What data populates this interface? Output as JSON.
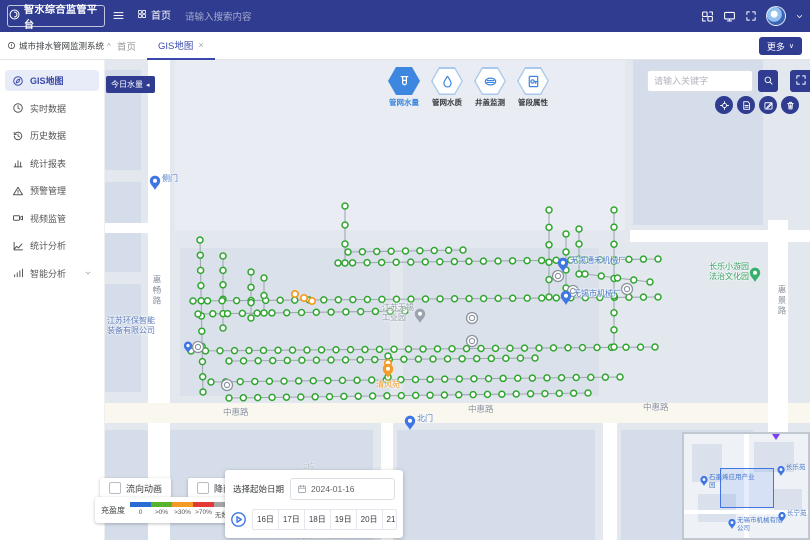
{
  "header": {
    "logo_text": "智水综合监管平台",
    "breadcrumb_home": "首页",
    "search_placeholder": "请输入搜索内容"
  },
  "tab_bar": {
    "tabs": [
      {
        "label": "首页",
        "active": false,
        "closable": false
      },
      {
        "label": "GIS地图",
        "active": true,
        "closable": true
      }
    ],
    "more_label": "更多"
  },
  "sidebar": {
    "title": "城市排水管网监测系统",
    "items": [
      {
        "label": "GIS地图",
        "icon": "compass",
        "active": true
      },
      {
        "label": "实时数据",
        "icon": "clock",
        "active": false
      },
      {
        "label": "历史数据",
        "icon": "history",
        "active": false
      },
      {
        "label": "统计报表",
        "icon": "bar-chart",
        "active": false
      },
      {
        "label": "预警管理",
        "icon": "alert",
        "active": false
      },
      {
        "label": "视频监管",
        "icon": "video",
        "active": false
      },
      {
        "label": "统计分析",
        "icon": "trend",
        "active": false
      },
      {
        "label": "智能分析",
        "icon": "signal",
        "active": false,
        "expandable": true
      }
    ]
  },
  "map": {
    "today_water_button": "今日水量",
    "layer_tools": [
      {
        "label": "管网水量",
        "icon": "water-meter",
        "active": true
      },
      {
        "label": "管网水质",
        "icon": "water-drop",
        "active": false
      },
      {
        "label": "井盖监测",
        "icon": "manhole",
        "active": false
      },
      {
        "label": "管段属性",
        "icon": "pipe",
        "active": false
      }
    ],
    "keyword_placeholder": "请输入关键字",
    "action_buttons": [
      {
        "icon": "locate"
      },
      {
        "icon": "report"
      },
      {
        "icon": "edit"
      },
      {
        "icon": "delete"
      }
    ],
    "road_labels": [
      {
        "text": "惠畅路",
        "x": 46,
        "y": 215,
        "vertical": true,
        "faint": false
      },
      {
        "text": "惠景路",
        "x": 671,
        "y": 225,
        "vertical": true,
        "faint": false
      },
      {
        "text": "中惠路",
        "x": 118,
        "y": 346,
        "vertical": false,
        "faint": false
      },
      {
        "text": "中惠路",
        "x": 363,
        "y": 343,
        "vertical": false,
        "faint": false
      },
      {
        "text": "中惠路",
        "x": 538,
        "y": 341,
        "vertical": false,
        "faint": false
      },
      {
        "text": "2栋",
        "x": 198,
        "y": 401,
        "vertical": false,
        "faint": true
      },
      {
        "text": "无锡环保机械",
        "x": 193,
        "y": 470,
        "vertical": false,
        "faint": true
      }
    ],
    "pois": [
      {
        "kind": "pin",
        "pin_color": "#3f76e4",
        "x": 50,
        "y": 130,
        "lines": [
          "侧门"
        ],
        "side": "right",
        "label_color": "#4a79c9"
      },
      {
        "kind": "pin",
        "pin_color": "#3f76e4",
        "x": 305,
        "y": 370,
        "lines": [
          "北门"
        ],
        "side": "right",
        "label_color": "#4a79c9"
      },
      {
        "kind": "pin",
        "pin_color": "#3f76e4",
        "x": 83,
        "y": 293,
        "lines": [],
        "side": "right",
        "label_color": "#4a79c9"
      },
      {
        "kind": "pin",
        "pin_color": "#3f76e4",
        "x": 458,
        "y": 212,
        "lines": [
          "无锡通禾机械厂"
        ],
        "side": "right",
        "label_color": "#4a79c9"
      },
      {
        "kind": "pin",
        "pin_color": "#3f76e4",
        "x": 461,
        "y": 245,
        "lines": [
          "无锡市机械厂"
        ],
        "side": "right",
        "label_color": "#4a79c9"
      },
      {
        "kind": "pin",
        "pin_color": "#35b06b",
        "x": 650,
        "y": 222,
        "lines": [
          "长乐小游园",
          "法治文化园"
        ],
        "side": "left",
        "label_color": "#35a05f"
      },
      {
        "kind": "pin",
        "pin_color": "#f59a23",
        "x": 283,
        "y": 318,
        "lines": [
          "清风苑"
        ],
        "side": "below",
        "label_color": "#f59a23"
      },
      {
        "kind": "pin",
        "pin_color": "#9aa3ae",
        "x": 315,
        "y": 263,
        "lines": [
          "江苏无锡",
          "工业园"
        ],
        "side": "left",
        "label_color": "#8d97a3"
      },
      {
        "kind": "text",
        "x": 2,
        "y": 256,
        "lines": [
          "江苏环保智能",
          "装备有限公司"
        ],
        "label_color": "#5b79b8"
      }
    ],
    "network": {
      "node_color": "#2fa52f",
      "orange_color": "#f59a23",
      "gray_color": "#8b949e",
      "line_color": "#a0a8b2",
      "lines": [
        {
          "x1": 95,
          "y1": 180,
          "x2": 98,
          "y2": 332,
          "n": 11
        },
        {
          "x1": 118,
          "y1": 196,
          "x2": 118,
          "y2": 268,
          "n": 6
        },
        {
          "x1": 88,
          "y1": 241,
          "x2": 553,
          "y2": 237,
          "n": 33
        },
        {
          "x1": 93,
          "y1": 254,
          "x2": 300,
          "y2": 251,
          "n": 15
        },
        {
          "x1": 86,
          "y1": 291,
          "x2": 550,
          "y2": 287,
          "n": 33
        },
        {
          "x1": 124,
          "y1": 301,
          "x2": 430,
          "y2": 298,
          "n": 22
        },
        {
          "x1": 106,
          "y1": 322,
          "x2": 515,
          "y2": 317,
          "n": 29
        },
        {
          "x1": 124,
          "y1": 338,
          "x2": 483,
          "y2": 333,
          "n": 26
        },
        {
          "x1": 233,
          "y1": 203,
          "x2": 553,
          "y2": 199,
          "n": 23
        },
        {
          "x1": 243,
          "y1": 192,
          "x2": 358,
          "y2": 190,
          "n": 9
        },
        {
          "x1": 240,
          "y1": 146,
          "x2": 240,
          "y2": 203,
          "n": 4
        },
        {
          "x1": 444,
          "y1": 150,
          "x2": 444,
          "y2": 237,
          "n": 6
        },
        {
          "x1": 509,
          "y1": 150,
          "x2": 509,
          "y2": 287,
          "n": 9
        },
        {
          "x1": 146,
          "y1": 212,
          "x2": 146,
          "y2": 258,
          "n": 4
        },
        {
          "x1": 159,
          "y1": 218,
          "x2": 159,
          "y2": 253,
          "n": 3
        },
        {
          "x1": 461,
          "y1": 174,
          "x2": 461,
          "y2": 228,
          "n": 4
        },
        {
          "x1": 474,
          "y1": 169,
          "x2": 474,
          "y2": 214,
          "n": 4
        },
        {
          "x1": 480,
          "y1": 214,
          "x2": 545,
          "y2": 222,
          "n": 5
        },
        {
          "x1": 283,
          "y1": 296,
          "x2": 283,
          "y2": 317,
          "n": 2
        }
      ],
      "orange_nodes": [
        [
          190,
          234
        ],
        [
          199,
          238
        ],
        [
          207,
          241
        ],
        [
          283,
          303
        ]
      ],
      "gray_markers": [
        [
          93,
          287
        ],
        [
          122,
          325
        ],
        [
          367,
          258
        ],
        [
          367,
          281
        ],
        [
          453,
          216
        ],
        [
          468,
          231
        ],
        [
          522,
          229
        ]
      ]
    }
  },
  "bottom_panel": {
    "toggles": [
      {
        "label": "流向动画",
        "checked": false
      },
      {
        "label": "降雨量",
        "checked": false
      }
    ],
    "legend": {
      "title": "充盈度",
      "items": [
        {
          "label": "0",
          "color": "#2b6bd4"
        },
        {
          "label": ">0%",
          "color": "#55b32c"
        },
        {
          "label": ">30%",
          "color": "#f59a23"
        },
        {
          "label": ">70%",
          "color": "#e23b36"
        },
        {
          "label": "无数据",
          "color": "#a6a6a6"
        }
      ]
    },
    "date_label": "选择起始日期",
    "date_value": "2024-01-16",
    "days": [
      "16日",
      "17日",
      "18日",
      "19日",
      "20日",
      "21日",
      "22日"
    ]
  },
  "minimap": {
    "pois": [
      {
        "label": "石墨烯应用产业园",
        "x": 20,
        "y": 52
      },
      {
        "label": "长乐苑",
        "x": 97,
        "y": 42
      },
      {
        "label": "长宁苑",
        "x": 98,
        "y": 88
      },
      {
        "label": "无锡市机械有限公司",
        "x": 48,
        "y": 95
      }
    ],
    "viewport": {
      "x": 36,
      "y": 34,
      "w": 52,
      "h": 38
    }
  },
  "colors": {
    "primary": "#2f3c8f",
    "active_blue": "#3949ab",
    "tool_blue": "#3d87e0",
    "node_green": "#2fa52f",
    "pin_blue": "#3f76e4",
    "orange": "#f59a23"
  }
}
